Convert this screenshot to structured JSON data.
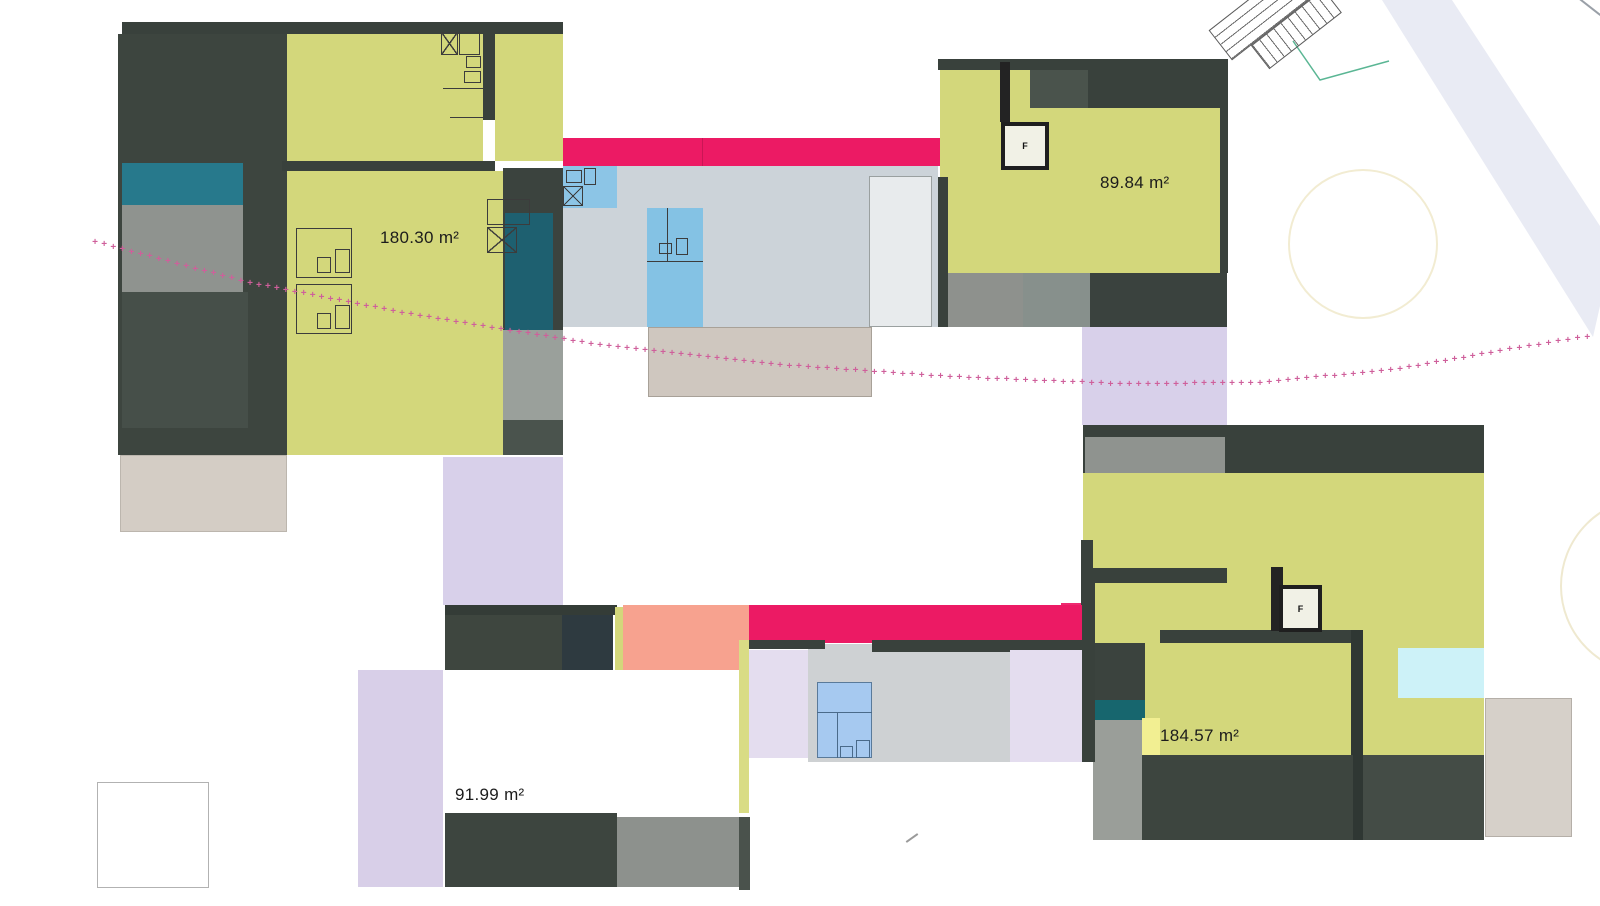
{
  "title": "Floor plan with unit areas",
  "units": {
    "top_left": {
      "area_label": "180.30 m²"
    },
    "top_right": {
      "area_label": "89.84 m²",
      "elevator_label": "F"
    },
    "bottom_left": {
      "area_label": "91.99 m²"
    },
    "bottom_right": {
      "area_label": "184.57 m²",
      "elevator_label": "F"
    }
  },
  "colors": {
    "room_fill": "#d3d77b",
    "wall_dark": "#39413c",
    "accent_magenta": "#ec1a64",
    "teal": "#27798c",
    "teal_dark": "#1e6070",
    "lavender": "#d8d0ea",
    "salmon": "#f7a28f",
    "sky_blue": "#8cc5e6",
    "periwinkle": "#a6c9f0",
    "pale_cyan": "#cdf2f8",
    "beige": "#d4cdc5",
    "gray_medium": "#8f938f",
    "boundary_pink": "#cf5f9b"
  },
  "boundary_line": {
    "marker": "+",
    "points": [
      [
        95,
        243
      ],
      [
        250,
        284
      ],
      [
        420,
        317
      ],
      [
        600,
        346
      ],
      [
        780,
        366
      ],
      [
        950,
        378
      ],
      [
        1120,
        385
      ],
      [
        1260,
        384
      ],
      [
        1400,
        370
      ],
      [
        1500,
        352
      ],
      [
        1597,
        336
      ]
    ]
  }
}
